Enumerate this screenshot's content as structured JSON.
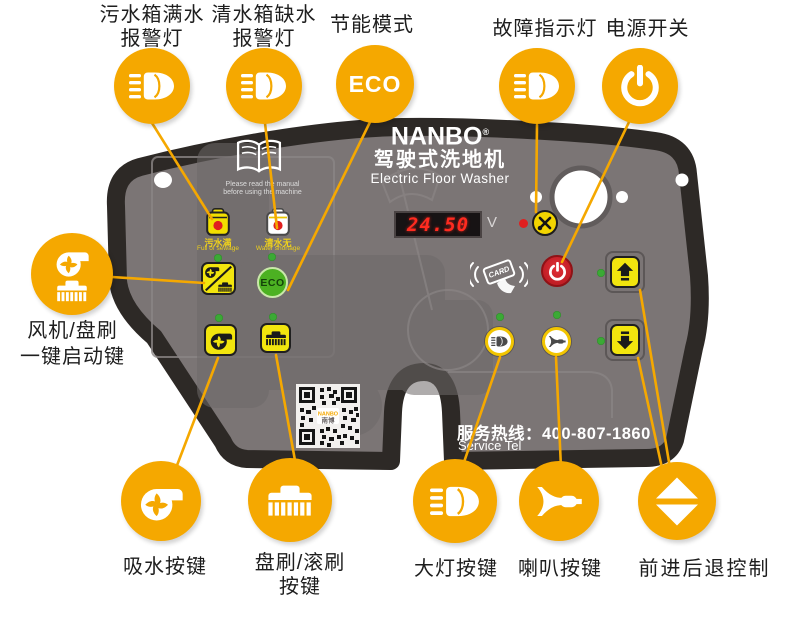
{
  "colors": {
    "accent_orange": "#F5A800",
    "panel_gray": "#7B7575",
    "panel_border": "#2D2926",
    "button_yellow": "#F2E50E",
    "led_green": "#3BAA35",
    "eco_green": "#4CB122",
    "power_red": "#D5232A",
    "display_red": "#FF2B20"
  },
  "callouts": {
    "top": [
      {
        "line1": "污水箱满水",
        "line2": "报警灯",
        "icon": "headlight-icon"
      },
      {
        "line1": "清水箱缺水",
        "line2": "报警灯",
        "icon": "headlight-icon"
      },
      {
        "line1": "节能模式",
        "icon_text": "ECO"
      },
      {
        "line1": "故障指示灯",
        "icon": "headlight-icon"
      },
      {
        "line1": "电源开关",
        "icon": "power-icon"
      }
    ],
    "left": {
      "line1": "风机/盘刷",
      "line2": "一键启动键",
      "icon": "fan-brush-icon"
    },
    "bottom": [
      {
        "line1": "吸水按键",
        "icon": "fan-icon"
      },
      {
        "line1": "盘刷/滚刷",
        "line2": "按键",
        "icon": "brush-icon"
      },
      {
        "line1": "大灯按键",
        "icon": "headlight-icon"
      },
      {
        "line1": "喇叭按键",
        "icon": "horn-icon"
      },
      {
        "line1": "前进后退控制",
        "icon": "up-down-arrows-icon"
      }
    ]
  },
  "panel": {
    "brand": {
      "logo": "NANBO",
      "reg": "®",
      "title_cn": "驾驶式洗地机",
      "title_en": "Electric Floor Washer"
    },
    "manual": {
      "line1": "Please read the manual",
      "line2": "before using the machine"
    },
    "indicators": {
      "sewage": {
        "cn": "污水满",
        "en": "Full of sewage"
      },
      "water": {
        "cn": "清水无",
        "en": "Water shortage"
      }
    },
    "display": {
      "value": "24.50",
      "unit": "V"
    },
    "buttons": {
      "eco": "ECO"
    },
    "card_label": "CARD",
    "service": {
      "label_cn": "服务热线：",
      "number": "400-807-1860",
      "label_en": "Service Tel"
    },
    "qr": {
      "brand": "NANBO",
      "brand_cn": "南博"
    }
  }
}
